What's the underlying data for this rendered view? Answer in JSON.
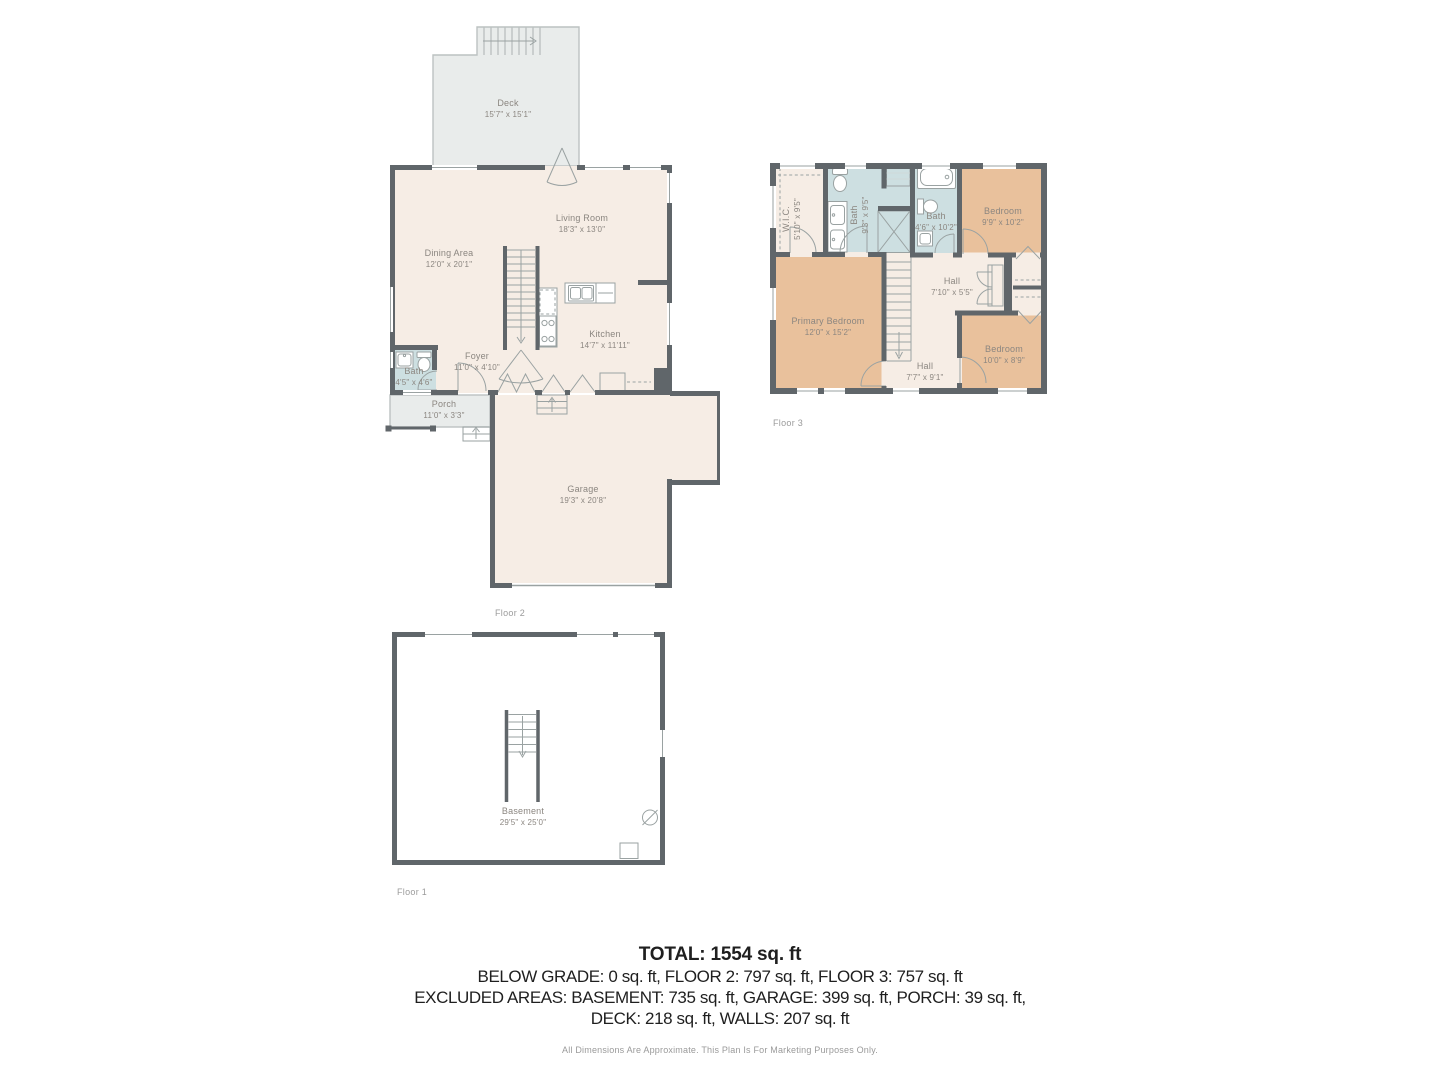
{
  "colors": {
    "wall": "#60666a",
    "floor": "#f6ede5",
    "deck": "#e9eceb",
    "bath": "#cddfe1",
    "bedroom": "#e9c19c",
    "fixture_line": "#9aa2a2",
    "label_text": "#8b8680"
  },
  "floor2": {
    "caption": "Floor 2",
    "rooms": {
      "deck": {
        "name": "Deck",
        "dims": "15'7\" x 15'1\""
      },
      "living_room": {
        "name": "Living Room",
        "dims": "18'3\" x 13'0\""
      },
      "dining_area": {
        "name": "Dining Area",
        "dims": "12'0\" x 20'1\""
      },
      "kitchen": {
        "name": "Kitchen",
        "dims": "14'7\" x 11'11\""
      },
      "foyer": {
        "name": "Foyer",
        "dims": "11'0\" x 4'10\""
      },
      "bath": {
        "name": "Bath",
        "dims": "4'5\" x 4'6\""
      },
      "porch": {
        "name": "Porch",
        "dims": "11'0\" x 3'3\""
      },
      "garage": {
        "name": "Garage",
        "dims": "19'3\" x 20'8\""
      }
    }
  },
  "floor3": {
    "caption": "Floor 3",
    "rooms": {
      "wic": {
        "name": "W.I.C.",
        "dims": "5'10\" x 9'5\""
      },
      "bath_large": {
        "name": "Bath",
        "dims": "9'3\" x 9'5\""
      },
      "bath_small": {
        "name": "Bath",
        "dims": "4'6\" x 10'2\""
      },
      "bedroom_top": {
        "name": "Bedroom",
        "dims": "9'9\" x 10'2\""
      },
      "hall_upper": {
        "name": "Hall",
        "dims": "7'10\" x 5'5\""
      },
      "primary_bedroom": {
        "name": "Primary Bedroom",
        "dims": "12'0\" x 15'2\""
      },
      "hall_lower": {
        "name": "Hall",
        "dims": "7'7\" x 9'1\""
      },
      "bedroom_bottom": {
        "name": "Bedroom",
        "dims": "10'0\" x 8'9\""
      }
    }
  },
  "floor1": {
    "caption": "Floor 1",
    "rooms": {
      "basement": {
        "name": "Basement",
        "dims": "29'5\" x 25'0\""
      }
    }
  },
  "summary": {
    "total": "TOTAL: 1554 sq. ft",
    "line2": "BELOW GRADE: 0 sq. ft, FLOOR 2: 797 sq. ft, FLOOR 3: 757 sq. ft",
    "line3": "EXCLUDED AREAS: BASEMENT: 735 sq. ft, GARAGE: 399 sq. ft, PORCH: 39 sq. ft,",
    "line4": "DECK: 218 sq. ft, WALLS: 207 sq. ft",
    "disclaimer": "All Dimensions Are Approximate. This Plan Is For Marketing Purposes Only."
  }
}
